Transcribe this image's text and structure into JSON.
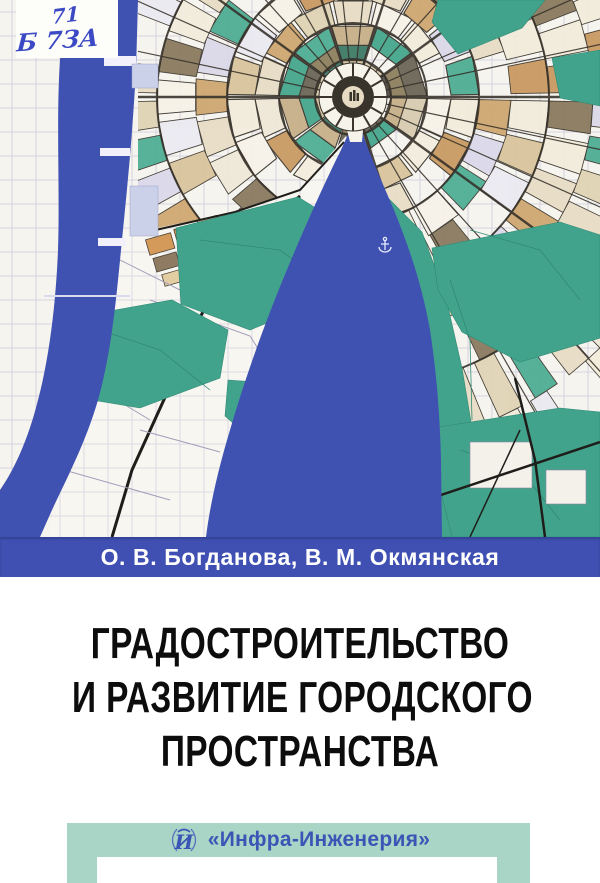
{
  "cover": {
    "library_label": {
      "line1": "71",
      "line2": "Б 7ЗА"
    },
    "authors_line": "О. В. Богданова, В. М. Окмянская",
    "title": {
      "line1": "ГРАДОСТРОИТЕЛЬСТВО",
      "line2": "И РАЗВИТИЕ ГОРОДСКОГО",
      "line3": "ПРОСТРАНСТВА"
    },
    "publisher": {
      "logo_letter": "И",
      "name": "«Инфра-Инженерия»"
    },
    "colors": {
      "author_band_blue": "#3f50b2",
      "river_blue": "#3f51b1",
      "park_green": "#42a38c",
      "footer_teal": "#a8d5c5",
      "publisher_blue": "#3a55b5",
      "title_black": "#0d0d0d"
    }
  }
}
